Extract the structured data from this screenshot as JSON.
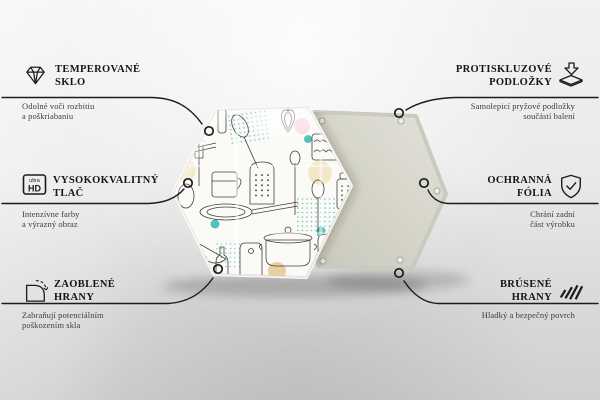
{
  "meta": {
    "kind": "product-feature-infographic",
    "product": "hexagonal glass board with kitchen doodle pattern",
    "language": "Czech / Slovak"
  },
  "colors": {
    "background_top": "#f1f1f1",
    "background_bottom": "#d0d0d0",
    "line": "#1c1c1c",
    "title_text": "#161616",
    "desc_text": "#3d3d3d",
    "front_face": "#fbfaf6",
    "back_face": "#d5d4c9",
    "accent_teal": "#4fc4ba",
    "accent_pink": "#f3c7d2",
    "accent_cream": "#f2e7c9",
    "accent_tan": "#e9cf9e"
  },
  "product": {
    "front_face": "white board printed with line-art kitchen utensils (pans, spoons, grater, cake, pot, cutting board) and pastel dots",
    "back_face": "plain protective back panel with screw holes",
    "screw_holes_visible": 5
  },
  "features_left": [
    {
      "icon": "diamond-icon",
      "title_line1": "TEMPEROVANÉ",
      "title_line2": "SKLO",
      "desc_line1": "Odolné voči rozbitiu",
      "desc_line2": "a poškriabaniu"
    },
    {
      "icon": "ultra-hd-icon",
      "title_line1": "VYSOKOKVALITNÝ",
      "title_line2": "TLAČ",
      "desc_line1": "Intenzívne farby",
      "desc_line2": "a výrazný obraz"
    },
    {
      "icon": "rounded-corner-icon",
      "title_line1": "ZAOBLENÉ",
      "title_line2": "HRANY",
      "desc_line1": "Zabraňují potenciálním",
      "desc_line2": "poškozením skla"
    }
  ],
  "features_right": [
    {
      "icon": "anti-slip-pad-icon",
      "title_line1": "PROTISKLUZOVÉ",
      "title_line2": "PODLOŽKY",
      "desc_line1": "Samolepicí pryžové podložky",
      "desc_line2": "součástí balení"
    },
    {
      "icon": "shield-check-icon",
      "title_line1": "OCHRANNÁ",
      "title_line2": "FÓLIA",
      "desc_line1": "Chrání zadní",
      "desc_line2": "část výrobku"
    },
    {
      "icon": "ground-edges-icon",
      "title_line1": "BRÚSENÉ",
      "title_line2": "HRANY",
      "desc_line1": "Hladký a bezpečný povrch",
      "desc_line2": ""
    }
  ],
  "ultra_hd_badge": {
    "top": "ultra",
    "bottom": "HD"
  }
}
